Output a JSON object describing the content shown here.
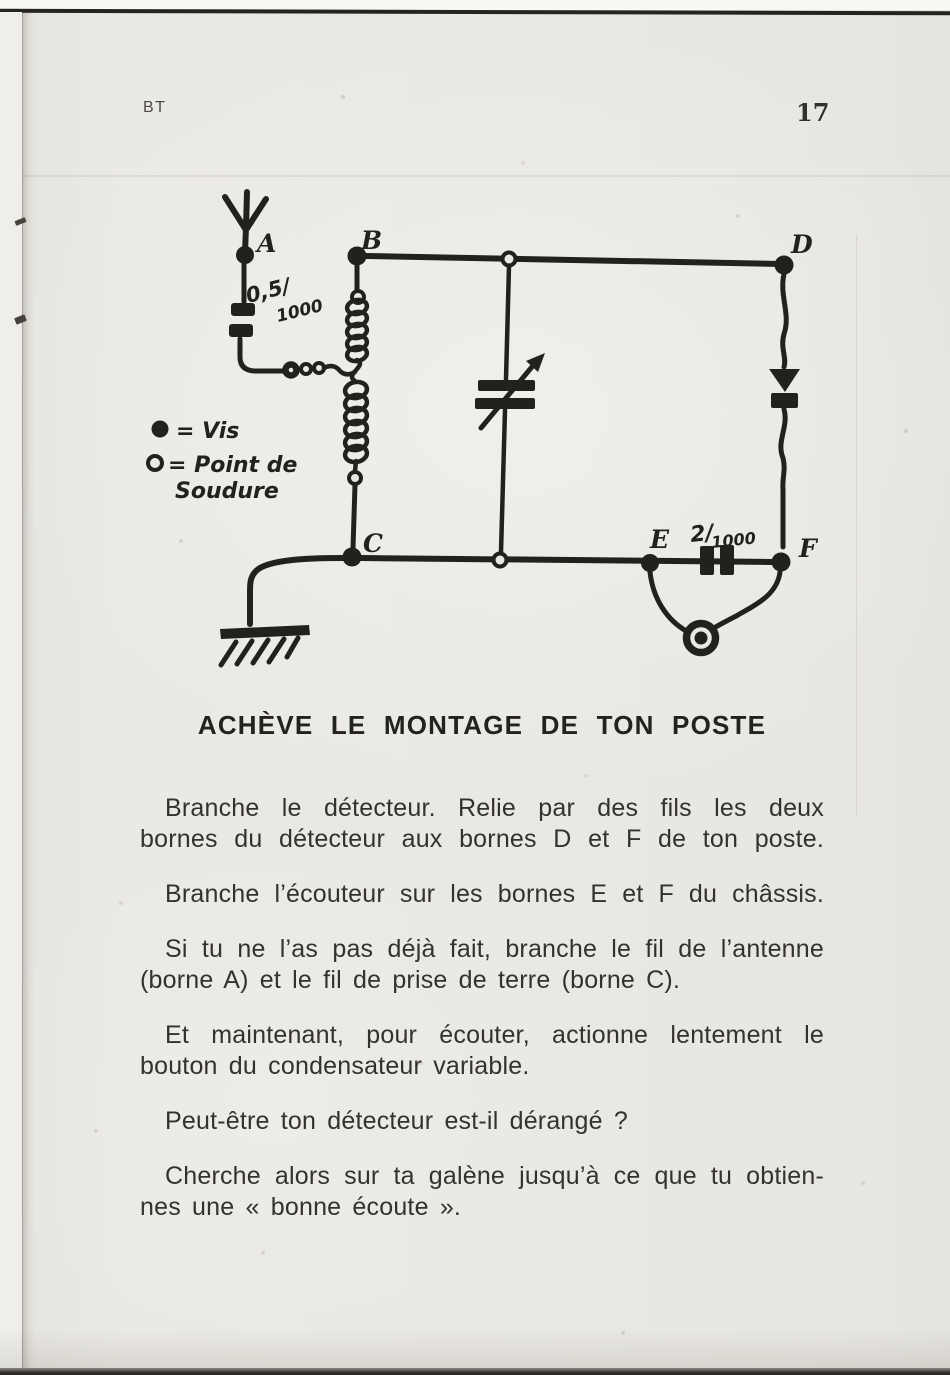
{
  "header": {
    "booklet_code": "BT",
    "page_number": "17"
  },
  "diagram": {
    "nodes": [
      "A",
      "B",
      "C",
      "D",
      "E",
      "F"
    ],
    "antenna_capacitor_label": {
      "part1": "0,5/",
      "part2": "1000"
    },
    "phone_capacitor_label": {
      "part1": "2/",
      "part2": "1000"
    },
    "legend": {
      "screw": "= Vis",
      "solder_line1": "= Point de",
      "solder_line2": "Soudure"
    }
  },
  "title": "ACHÈVE LE MONTAGE DE TON POSTE",
  "body": {
    "paragraphs": [
      {
        "lines": [
          "Branche le détecteur. Relie par des fils les deux",
          "bornes du détecteur aux bornes D et F de ton poste."
        ]
      },
      {
        "lines": [
          "Branche l’écouteur sur les bornes E et F du châssis."
        ]
      },
      {
        "lines": [
          "Si tu ne l’as pas déjà fait, branche le fil de l’antenne",
          "(borne A) et le fil de prise de terre (borne C)."
        ]
      },
      {
        "lines": [
          "Et maintenant, pour écouter, actionne lentement le",
          "bouton du condensateur variable."
        ]
      },
      {
        "lines": [
          "Peut-être ton détecteur est-il dérangé ?"
        ]
      },
      {
        "lines": [
          "Cherche alors sur ta galène jusqu’à ce que tu obtien-",
          "nes une « bonne écoute »."
        ]
      }
    ]
  },
  "colors": {
    "paper": "#eae8e2",
    "ink": "#23211e",
    "text": "#34322e"
  }
}
